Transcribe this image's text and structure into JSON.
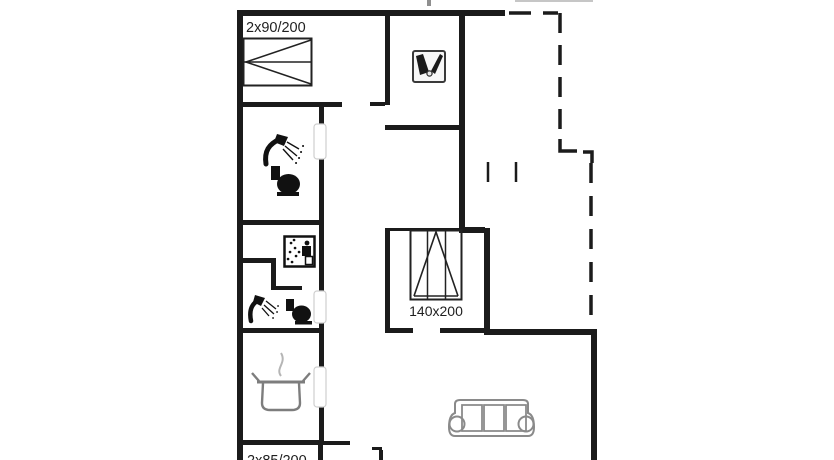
{
  "plan": {
    "type": "holiday-home-floor-plan",
    "labels": {
      "top_bed_size": "2x90/200",
      "middle_bed_size": "140x200",
      "bottom_bed_size_partial": "2x85/200"
    },
    "colors": {
      "wall": "#1b1b1b",
      "icon": "#111111",
      "furniture_gray": "#7d7d7d",
      "sofa_gray": "#8a8a8a",
      "door_outline": "#cfcfcf",
      "text": "#1f1f1f",
      "background": "#ffffff"
    },
    "icons": {
      "bedroom_1": "double-bed-icon",
      "entry_room": "utility-rack-icon",
      "bathroom_1": [
        "shower-icon",
        "toilet-icon"
      ],
      "sauna_room": "sauna-icon",
      "bathroom_2": [
        "shower-icon",
        "toilet-icon"
      ],
      "kitchen": "cooking-pot-icon",
      "bedroom_2": "double-bed-icon",
      "living_room": "sofa-icon"
    }
  }
}
